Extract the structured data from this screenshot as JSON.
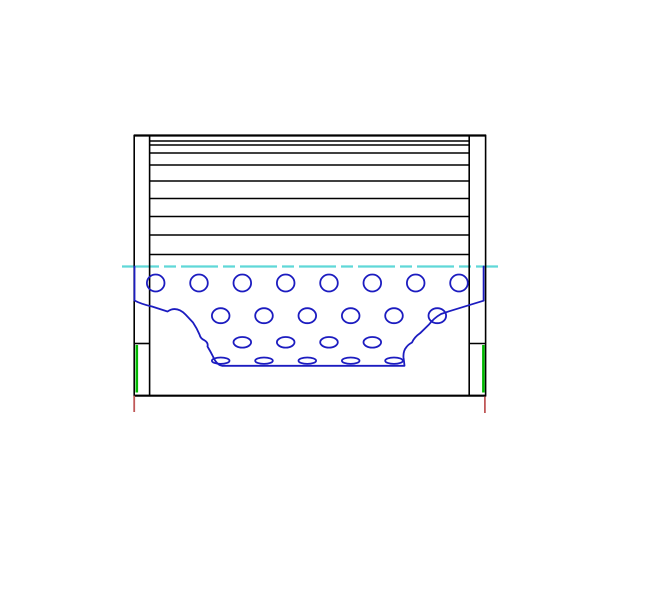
{
  "drawing": {
    "name": "pleated-filter-element-section-view",
    "canvas": {
      "width": 668,
      "height": 616,
      "background": "#ffffff"
    },
    "colors": {
      "outline": "#000000",
      "perforation": "#1c1cc0",
      "centerline": "#5fd8d8",
      "seal": "#00b800",
      "datum": "#c05858"
    },
    "stroke_widths": {
      "outline": 1.6,
      "top_edge": 2.2,
      "bottom_edge": 2.2,
      "perforation": 1.8,
      "centerline": 2.2,
      "seal": 2.6,
      "datum": 1.8
    },
    "centerline": {
      "y": 266.5,
      "x1": 122,
      "x2": 498,
      "dash": "37 5 12 5"
    },
    "top_edge": {
      "y": 135.5,
      "x1": 134,
      "x2": 486
    },
    "bottom_edge": {
      "y": 395.7,
      "x1": 134,
      "x2": 486
    },
    "pleat_lines": {
      "x1": 150,
      "x2": 468.5,
      "ys": [
        141,
        145,
        153,
        165,
        181,
        198.5,
        216.5,
        235,
        254.5
      ]
    },
    "end_caps": [
      {
        "side": "left",
        "x": 134.2,
        "y": 135.5,
        "w": 15.4,
        "h": 260.2,
        "divider_y": 343.5
      },
      {
        "side": "right",
        "x": 469.2,
        "y": 135.5,
        "w": 16.4,
        "h": 260.2,
        "divider_y": 343.5
      }
    ],
    "seal_lines": [
      {
        "x": 136.8,
        "y1": 345,
        "y2": 392.5
      },
      {
        "x": 483.4,
        "y1": 345,
        "y2": 392.5
      }
    ],
    "datum_ticks": [
      {
        "x": 134.2,
        "y1": 395.7,
        "y2": 412
      },
      {
        "x": 484.9,
        "y1": 396.5,
        "y2": 413
      }
    ],
    "cutaway_outline": "M134.5,266.5 L134.5,300.5 Q141,304 152,306.5 L167.5,311.5 Q176.5,305.5 185.5,314.5 L193,322.5 Q197,328.5 199.5,334.5 Q200.5,338.5 204,340 Q208.5,342.5 207.5,346.5 Q210.5,351.5 213,356.5 Q215,361.5 218.5,364.3 Q219.8,365.4 222,365.8 L404.5,365.8 Q404,361 403.5,357.5 Q403,351 406.5,347 Q408.3,344.5 412,342.5 Q414.5,337 420,333.3 L429,324.5 Q434,318 441,314 L449,311.3 L483.6,300.7 L483.6,266.5",
    "perforation_rows": [
      {
        "cy": 283,
        "rx": 8.8,
        "ry": 8.5,
        "cx": [
          155.7,
          199,
          242.3,
          285.7,
          329,
          372.3,
          415.7,
          459
        ]
      },
      {
        "cy": 315.7,
        "rx": 8.8,
        "ry": 7.5,
        "cx": [
          220.7,
          264,
          307.3,
          350.7,
          394,
          437.3
        ]
      },
      {
        "cy": 342.3,
        "rx": 8.8,
        "ry": 5.3,
        "cx": [
          242.3,
          285.7,
          329,
          372.3
        ]
      },
      {
        "cy": 360.7,
        "rx": 8.8,
        "ry": 3.2,
        "cx": [
          220.7,
          264,
          307.3,
          350.7,
          394
        ]
      }
    ]
  }
}
